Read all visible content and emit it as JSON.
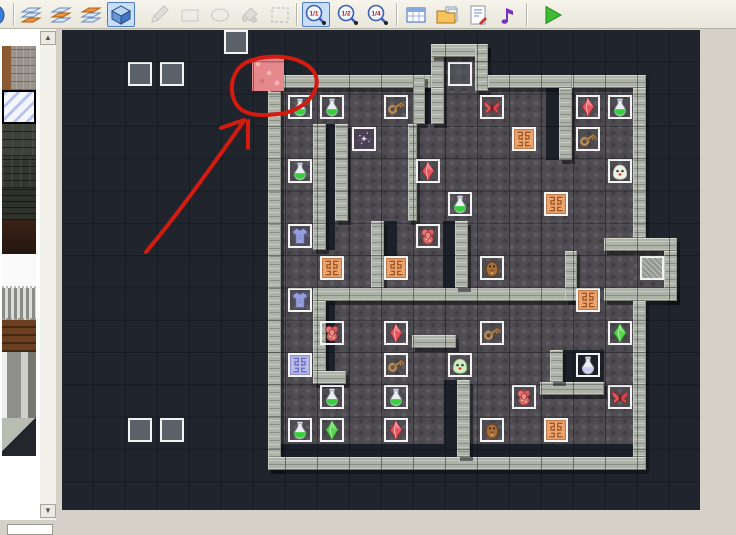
{
  "app": {
    "description": "tile map editor with event layer active",
    "zoom_level": "1/1"
  },
  "toolbar": {
    "items": [
      {
        "type": "button",
        "name": "partial-icon",
        "glyph": "partial",
        "x": -9
      },
      {
        "type": "separator",
        "x": 13
      },
      {
        "type": "button",
        "name": "layer-1-button",
        "glyph": "layers",
        "hi": 2,
        "x": 17
      },
      {
        "type": "button",
        "name": "layer-2-button",
        "glyph": "layers",
        "hi": 1,
        "x": 47
      },
      {
        "type": "button",
        "name": "layer-3-button",
        "glyph": "layers",
        "hi": 0,
        "x": 77
      },
      {
        "type": "button",
        "name": "event-layer-button",
        "glyph": "cube",
        "x": 107,
        "selected": true
      },
      {
        "type": "button",
        "name": "pencil-tool-button",
        "glyph": "pencil",
        "x": 145,
        "disabled": true
      },
      {
        "type": "button",
        "name": "rectangle-tool-button",
        "glyph": "rect",
        "x": 176,
        "disabled": true
      },
      {
        "type": "button",
        "name": "ellipse-tool-button",
        "glyph": "ellipse",
        "x": 206,
        "disabled": true
      },
      {
        "type": "button",
        "name": "fill-tool-button",
        "glyph": "fill",
        "x": 236,
        "disabled": true
      },
      {
        "type": "button",
        "name": "select-tool-button",
        "glyph": "select",
        "x": 266,
        "disabled": true
      },
      {
        "type": "separator",
        "x": 296
      },
      {
        "type": "button",
        "name": "zoom-1-1-button",
        "glyph": "zoom",
        "label": "1/1",
        "x": 302,
        "selected": true
      },
      {
        "type": "button",
        "name": "zoom-1-2-button",
        "glyph": "zoom",
        "label": "1/2",
        "x": 334
      },
      {
        "type": "button",
        "name": "zoom-1-4-button",
        "glyph": "zoom",
        "label": "1/4",
        "x": 364
      },
      {
        "type": "separator",
        "x": 396
      },
      {
        "type": "button",
        "name": "database-button",
        "glyph": "db",
        "x": 402
      },
      {
        "type": "button",
        "name": "materials-button",
        "glyph": "materials",
        "x": 433
      },
      {
        "type": "button",
        "name": "script-button",
        "glyph": "script",
        "x": 464
      },
      {
        "type": "button",
        "name": "music-button",
        "glyph": "music",
        "x": 494
      },
      {
        "type": "separator",
        "x": 526
      },
      {
        "type": "button",
        "name": "play-button",
        "glyph": "play",
        "x": 538
      }
    ]
  },
  "palette": {
    "tiles": [
      {
        "name": "stone-brick-tile",
        "cls": "t-stonebrick",
        "y": 17,
        "h": 44
      },
      {
        "name": "ice-crystal-tile",
        "cls": "t-ice",
        "y": 61,
        "h": 34,
        "selected": true
      },
      {
        "name": "dark-stone-tile",
        "cls": "t-darkstone",
        "y": 95,
        "h": 32
      },
      {
        "name": "dark-stone-tile-2",
        "cls": "t-darkstone2",
        "y": 127,
        "h": 32
      },
      {
        "name": "dark-brick-tile",
        "cls": "t-darkbrick",
        "y": 159,
        "h": 32
      },
      {
        "name": "maroon-tile",
        "cls": "t-maroon",
        "y": 191,
        "h": 34
      },
      {
        "name": "white-tile",
        "cls": "t-whitetile",
        "y": 225,
        "h": 34
      },
      {
        "name": "bars-tile",
        "cls": "t-bars",
        "y": 259,
        "h": 32
      },
      {
        "name": "wood-plank-tile",
        "cls": "t-wood",
        "y": 291,
        "h": 32
      },
      {
        "name": "pillar-tile",
        "cls": "t-pillar",
        "y": 323,
        "h": 66
      },
      {
        "name": "ramp-tile",
        "cls": "t-ramp",
        "y": 389,
        "h": 38
      }
    ],
    "scrollbar": {
      "up_glyph": "▲",
      "down_glyph": "▼"
    }
  },
  "map": {
    "grid": {
      "origin_x": 60,
      "origin_y": 26,
      "tile_w": 32,
      "tile_h": 32.3,
      "cols": 21,
      "rows": 15
    },
    "colors": {
      "canvas_bg": "#20242d",
      "floor": "#4e4b51",
      "wall": "#aeb3a9",
      "pink_tile": "#e5898c",
      "annotation": "#d31b10",
      "event_border": "#f2f2f2"
    },
    "floors": [
      [
        281,
        88,
        352,
        369
      ],
      [
        444,
        57,
        31,
        34
      ],
      [
        633,
        251,
        31,
        37
      ]
    ],
    "channels": [
      [
        326,
        124,
        9,
        126
      ],
      [
        425,
        88,
        6,
        36
      ],
      [
        444,
        380,
        13,
        77
      ],
      [
        281,
        444,
        352,
        13
      ],
      [
        546,
        88,
        13,
        72
      ],
      [
        384,
        221,
        13,
        37
      ],
      [
        443,
        221,
        12,
        67
      ],
      [
        326,
        301,
        9,
        70
      ],
      [
        563,
        350,
        41,
        32
      ]
    ],
    "walls": [
      [
        268,
        75,
        13,
        395
      ],
      [
        268,
        75,
        163,
        13
      ],
      [
        431,
        44,
        13,
        44
      ],
      [
        431,
        44,
        57,
        13
      ],
      [
        475,
        44,
        13,
        47
      ],
      [
        488,
        75,
        84,
        13
      ],
      [
        572,
        75,
        74,
        13
      ],
      [
        559,
        88,
        13,
        72
      ],
      [
        633,
        88,
        13,
        150
      ],
      [
        604,
        238,
        73,
        13
      ],
      [
        664,
        251,
        13,
        50
      ],
      [
        604,
        288,
        73,
        13
      ],
      [
        633,
        301,
        13,
        156
      ],
      [
        268,
        457,
        378,
        13
      ],
      [
        313,
        124,
        13,
        126
      ],
      [
        335,
        124,
        13,
        97
      ],
      [
        371,
        221,
        13,
        67
      ],
      [
        313,
        288,
        259,
        13
      ],
      [
        313,
        301,
        13,
        70
      ],
      [
        457,
        380,
        13,
        77
      ],
      [
        431,
        88,
        13,
        36
      ],
      [
        413,
        75,
        12,
        49
      ],
      [
        408,
        124,
        9,
        97
      ],
      [
        313,
        371,
        33,
        13
      ],
      [
        412,
        335,
        44,
        13
      ],
      [
        565,
        251,
        12,
        50
      ],
      [
        455,
        221,
        13,
        67
      ],
      [
        540,
        382,
        64,
        13
      ],
      [
        550,
        350,
        13,
        32
      ]
    ],
    "special_tiles": [
      {
        "name": "pink-marked-tile",
        "col": 6,
        "row": 1
      }
    ],
    "events": [
      {
        "col": 5,
        "row": 0,
        "fill": "gray"
      },
      {
        "col": 2,
        "row": 1,
        "fill": "gray"
      },
      {
        "col": 3,
        "row": 1,
        "fill": "gray"
      },
      {
        "col": 12,
        "row": 1,
        "fill": "floor"
      },
      {
        "col": 18,
        "row": 7,
        "fill": "stone"
      },
      {
        "col": 2,
        "row": 12,
        "fill": "gray"
      },
      {
        "col": 3,
        "row": 12,
        "fill": "gray"
      }
    ],
    "items": [
      {
        "col": 7,
        "row": 2,
        "type": "potion-green"
      },
      {
        "col": 8,
        "row": 2,
        "type": "potion-green"
      },
      {
        "col": 10,
        "row": 2,
        "type": "key"
      },
      {
        "col": 13,
        "row": 2,
        "type": "moth"
      },
      {
        "col": 16,
        "row": 2,
        "type": "crystal-red"
      },
      {
        "col": 17,
        "row": 2,
        "type": "potion-green"
      },
      {
        "col": 9,
        "row": 3,
        "type": "magic"
      },
      {
        "col": 14,
        "row": 3,
        "type": "rune-orange"
      },
      {
        "col": 16,
        "row": 3,
        "type": "key"
      },
      {
        "col": 7,
        "row": 4,
        "type": "potion-green"
      },
      {
        "col": 11,
        "row": 4,
        "type": "crystal-red"
      },
      {
        "col": 17,
        "row": 4,
        "type": "slime-white"
      },
      {
        "col": 12,
        "row": 5,
        "type": "potion-green"
      },
      {
        "col": 15,
        "row": 5,
        "type": "rune-orange"
      },
      {
        "col": 7,
        "row": 6,
        "type": "armor"
      },
      {
        "col": 11,
        "row": 6,
        "type": "rose"
      },
      {
        "col": 8,
        "row": 7,
        "type": "rune-orange"
      },
      {
        "col": 10,
        "row": 7,
        "type": "rune-orange"
      },
      {
        "col": 13,
        "row": 7,
        "type": "owl"
      },
      {
        "col": 7,
        "row": 8,
        "type": "armor"
      },
      {
        "col": 16,
        "row": 8,
        "type": "rune-orange"
      },
      {
        "col": 8,
        "row": 9,
        "type": "rose"
      },
      {
        "col": 10,
        "row": 9,
        "type": "crystal-red"
      },
      {
        "col": 13,
        "row": 9,
        "type": "key"
      },
      {
        "col": 17,
        "row": 9,
        "type": "crystal-green"
      },
      {
        "col": 7,
        "row": 10,
        "type": "rune-blue"
      },
      {
        "col": 10,
        "row": 10,
        "type": "key"
      },
      {
        "col": 12,
        "row": 10,
        "type": "slime-green"
      },
      {
        "col": 16,
        "row": 10,
        "type": "potion-white"
      },
      {
        "col": 8,
        "row": 11,
        "type": "potion-green"
      },
      {
        "col": 10,
        "row": 11,
        "type": "potion-green"
      },
      {
        "col": 14,
        "row": 11,
        "type": "rose"
      },
      {
        "col": 17,
        "row": 11,
        "type": "moth"
      },
      {
        "col": 7,
        "row": 12,
        "type": "potion-green"
      },
      {
        "col": 8,
        "row": 12,
        "type": "crystal-green"
      },
      {
        "col": 10,
        "row": 12,
        "type": "crystal-red"
      },
      {
        "col": 13,
        "row": 12,
        "type": "owl"
      },
      {
        "col": 15,
        "row": 12,
        "type": "rune-orange"
      }
    ],
    "annotation": {
      "circle_path": "M246,112 C228,106 226,72 247,62 C270,52 306,56 315,74 C323,92 302,112 278,114 C264,116 252,115 246,112",
      "arrow_path": "M146,252 C178,214 212,166 244,121",
      "barb_path": "M244,120 L221,128",
      "tail_path": "M248,121 L248,148"
    }
  }
}
